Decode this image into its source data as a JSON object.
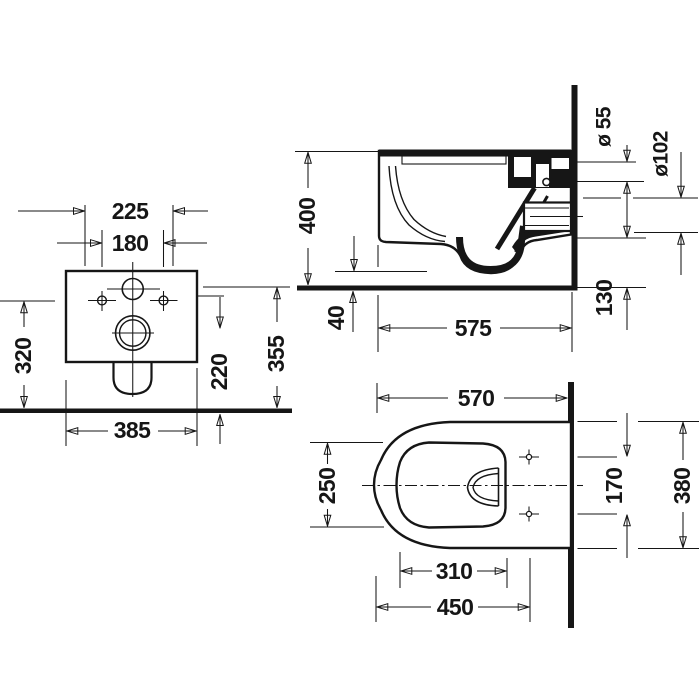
{
  "drawing": {
    "rear_view": {
      "seat_fixing_width": "225",
      "bolt_hole_spacing": "180",
      "height_to_holes": "320",
      "height_to_supply": "355",
      "height_to_outlet": "220",
      "body_width": "385"
    },
    "side_view": {
      "overall_height": "400",
      "floor_clearance": "40",
      "projection_depth": "575",
      "outlet_bottom_height": "130",
      "supply_pipe_diameter": "ø 55",
      "outlet_pipe_diameter": "ø102"
    },
    "plan_view": {
      "overall_depth": "570",
      "bowl_inner_width": "250",
      "bowl_inner_length": "310",
      "front_to_fixing_holes": "450",
      "fixing_hole_spacing": "170",
      "body_width": "380"
    }
  }
}
